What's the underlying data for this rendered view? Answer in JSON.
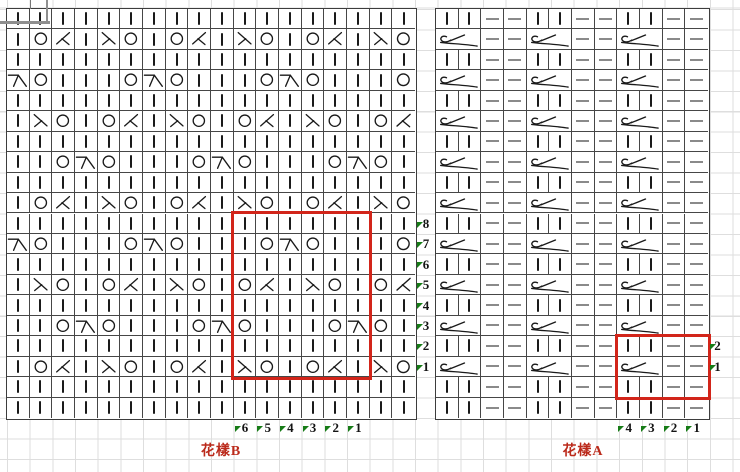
{
  "page": {
    "background_color": "#ffffff",
    "faint_grid_color": "#dedede",
    "chart_line_color": "#464646"
  },
  "colors": {
    "accent_red": "#d2251a",
    "label_red": "#bb2a1b",
    "marker_green": "#177c17",
    "symbol_black": "#1a1a1a",
    "purl_gray": "#8a8a8a"
  },
  "symbols_legend": {
    "i": "knit-bar",
    "k": "knit-bar",
    "o": "yarn-over",
    "l": "left-point-decrease",
    "r": "right-point-decrease",
    "b": "top-bar-decrease",
    "p": "purl-dash",
    "T": "two-stitch-twist"
  },
  "left_chart": {
    "label": "花樣B",
    "cols": 18,
    "rows": 20,
    "grid": [
      "iiiiiiiiiiiiiiiiii",
      "ioliroioliroioliro",
      "iiiiiiiiiiiiiiiiii",
      "boiiioboiiioboiiio",
      "iiiiiiiiiiiiiiiiii",
      "iroioliroioliroiol",
      "iiiiiiiiiiiiiiiiii",
      "iioboiiioboiiioboi",
      "iiiiiiiiiiiiiiiiii",
      "ioliroioliroioliro",
      "iiiiiiiiiiiiiiiiii",
      "boiiioboiiioboiiio",
      "iiiiiiiiiiiiiiiiii",
      "iroioliroioliroiol",
      "iiiiiiiiiiiiiiiiii",
      "iioboiiioboiiioboi",
      "iiiiiiiiiiiiiiiiii",
      "ioliroioliroioliro",
      "iiiiiiiiiiiiiiiiii",
      "iiiiiiiiiiiiiiiiii"
    ],
    "side_numbers": [
      "8",
      "7",
      "6",
      "5",
      "4",
      "3",
      "2",
      "1"
    ],
    "side_numbers_start_row": 11,
    "bottom_numbers": [
      "6",
      "5",
      "4",
      "3",
      "2",
      "1"
    ],
    "bottom_numbers_start_col": 11,
    "red_box": {
      "col_start": 11,
      "col_end": 16,
      "row_start": 11,
      "row_end": 18
    }
  },
  "right_chart": {
    "label": "花樣A",
    "cols": 12,
    "rows": 20,
    "grid": [
      "kkppkkppkkpp",
      "T.ppT.ppT.pp",
      "kkppkkppkkpp",
      "T.ppT.ppT.pp",
      "kkppkkppkkpp",
      "T.ppT.ppT.pp",
      "kkppkkppkkpp",
      "T.ppT.ppT.pp",
      "kkppkkppkkpp",
      "T.ppT.ppT.pp",
      "kkppkkppkkpp",
      "T.ppT.ppT.pp",
      "kkppkkppkkpp",
      "T.ppT.ppT.pp",
      "kkppkkppkkpp",
      "T.ppT.ppT.pp",
      "kkppkkppkkpp",
      "T.ppT.ppT.pp",
      "kkppkkppkkpp",
      "kkppkkppkkpp"
    ],
    "side_numbers": [
      "2",
      "1"
    ],
    "side_numbers_start_row": 17,
    "bottom_numbers": [
      "4",
      "3",
      "2",
      "1"
    ],
    "bottom_numbers_start_col": 9,
    "red_box": {
      "col_start": 9,
      "col_end": 12,
      "row_start": 17,
      "row_end": 19
    }
  }
}
